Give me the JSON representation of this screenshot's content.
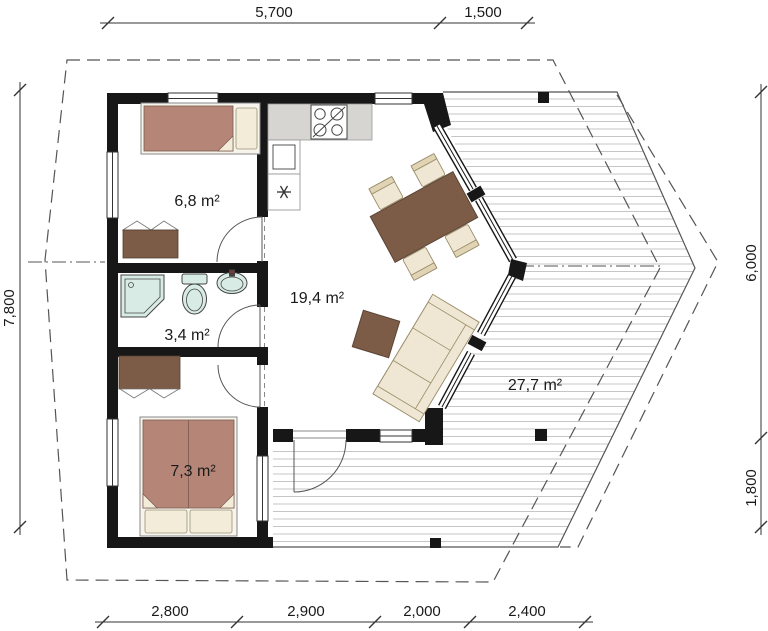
{
  "plan": {
    "type": "floor-plan",
    "rooms": {
      "bedroom_small": {
        "area_label": "6,8 m²"
      },
      "bathroom": {
        "area_label": "3,4 m²"
      },
      "bedroom_large": {
        "area_label": "7,3 m²"
      },
      "living_room": {
        "area_label": "19,4 m²"
      },
      "terrace": {
        "area_label": "27,7 m²"
      }
    },
    "dimensions": {
      "top": [
        "5,700",
        "1,500"
      ],
      "bottom": [
        "2,800",
        "2,900",
        "2,000",
        "2,400"
      ],
      "left": [
        "7,800"
      ],
      "right": [
        "6,000",
        "1,800"
      ]
    },
    "icons": {
      "freezer_symbol": "*"
    },
    "colors": {
      "wall": "#171717",
      "bed": "#b58677",
      "wood_furniture": "#7d5c47",
      "upholstery": "#efe7d3",
      "pillow": "#f2ecd9",
      "sanitary": "#d8ece5",
      "counter": "#d7d5d1",
      "deck_plank": "#c6c6c6",
      "dash_line": "#555555",
      "dim_line": "#333333"
    }
  }
}
